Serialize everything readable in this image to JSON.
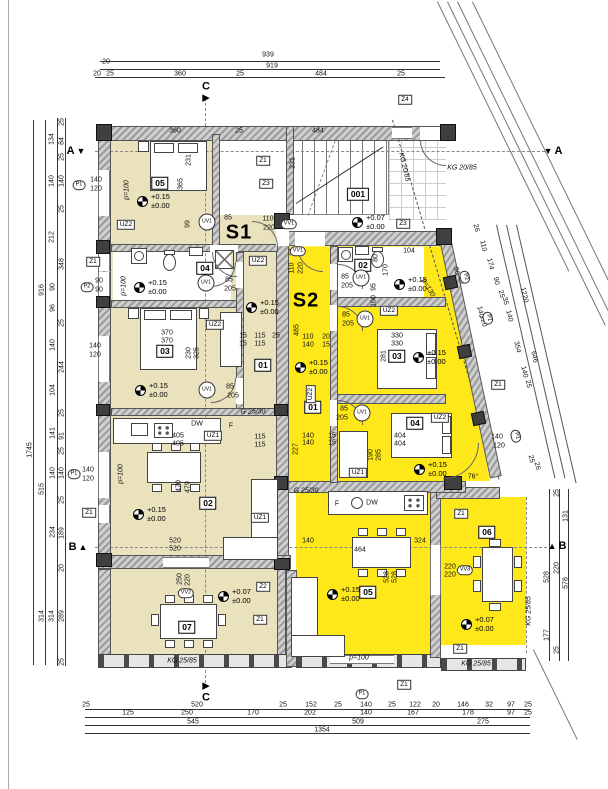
{
  "colors": {
    "s1_fill": "#e9e2bd",
    "s2_fill": "#ffe81a"
  },
  "units": [
    {
      "t": "S1",
      "x": 239,
      "y": 233
    },
    {
      "t": "S2",
      "x": 306,
      "y": 301
    }
  ],
  "sections": [
    {
      "t": "A",
      "tri": "▼",
      "x": 76,
      "y": 151,
      "side": "l"
    },
    {
      "t": "A",
      "tri": "▼",
      "x": 553,
      "y": 151,
      "side": "r"
    },
    {
      "t": "B",
      "tri": "▲",
      "x": 78,
      "y": 547,
      "side": "l"
    },
    {
      "t": "B",
      "tri": "▲",
      "x": 557,
      "y": 546,
      "side": "r"
    },
    {
      "t": "C",
      "tri": "▶",
      "x": 206,
      "y": 92,
      "side": "t"
    },
    {
      "t": "C",
      "tri": "▶",
      "x": 206,
      "y": 692,
      "side": "b"
    }
  ],
  "roomboxes": [
    {
      "t": "05",
      "x": 160,
      "y": 183
    },
    {
      "t": "001",
      "x": 358,
      "y": 194
    },
    {
      "t": "04",
      "x": 205,
      "y": 268
    },
    {
      "t": "02",
      "x": 363,
      "y": 265
    },
    {
      "t": "03",
      "x": 165,
      "y": 351
    },
    {
      "t": "01",
      "x": 263,
      "y": 365
    },
    {
      "t": "03",
      "x": 397,
      "y": 356
    },
    {
      "t": "01",
      "x": 313,
      "y": 407
    },
    {
      "t": "04",
      "x": 415,
      "y": 423
    },
    {
      "t": "02",
      "x": 208,
      "y": 503
    },
    {
      "t": "05",
      "x": 368,
      "y": 592
    },
    {
      "t": "07",
      "x": 187,
      "y": 627
    },
    {
      "t": "06",
      "x": 487,
      "y": 532
    }
  ],
  "zboxes": [
    {
      "t": "Z4",
      "x": 405,
      "y": 100
    },
    {
      "t": "Z1",
      "x": 263,
      "y": 161
    },
    {
      "t": "Z3",
      "x": 266,
      "y": 184
    },
    {
      "t": "Z3",
      "x": 403,
      "y": 224
    },
    {
      "t": "Z2",
      "x": 263,
      "y": 587
    },
    {
      "t": "Z1",
      "x": 260,
      "y": 620
    },
    {
      "t": "Z1",
      "x": 461,
      "y": 514
    },
    {
      "t": "Z1",
      "x": 460,
      "y": 649
    },
    {
      "t": "Z1",
      "x": 404,
      "y": 685
    },
    {
      "t": "Z1",
      "x": 498,
      "y": 385
    },
    {
      "t": "Z1",
      "x": 89,
      "y": 513
    },
    {
      "t": "Z1",
      "x": 93,
      "y": 262
    }
  ],
  "uzboxes": [
    {
      "t": "UZ2",
      "x": 126,
      "y": 225
    },
    {
      "t": "UZ2",
      "x": 215,
      "y": 325
    },
    {
      "t": "UZ2",
      "x": 258,
      "y": 261
    },
    {
      "t": "UZ1",
      "x": 213,
      "y": 436
    },
    {
      "t": "UZ1",
      "x": 260,
      "y": 518
    },
    {
      "t": "UZ2",
      "x": 389,
      "y": 311
    },
    {
      "t": "UZ2",
      "x": 440,
      "y": 418
    },
    {
      "t": "UZ1",
      "x": 358,
      "y": 473
    },
    {
      "t": "UZ2",
      "x": 311,
      "y": 394,
      "r": -90
    }
  ],
  "circles": [
    {
      "t": "UV1",
      "x": 207,
      "y": 222
    },
    {
      "t": "UV1",
      "x": 206,
      "y": 283
    },
    {
      "t": "UV1",
      "x": 207,
      "y": 390
    },
    {
      "t": "UV1",
      "x": 361,
      "y": 278
    },
    {
      "t": "UV1",
      "x": 365,
      "y": 319
    },
    {
      "t": "UV1",
      "x": 362,
      "y": 413
    }
  ],
  "hexes": [
    {
      "t": "VV1",
      "x": 289,
      "y": 224
    },
    {
      "t": "VV1",
      "x": 298,
      "y": 251
    },
    {
      "t": "VV2",
      "x": 186,
      "y": 593
    },
    {
      "t": "VV3",
      "x": 465,
      "y": 570
    },
    {
      "t": "P1",
      "x": 79,
      "y": 185
    },
    {
      "t": "P2",
      "x": 87,
      "y": 287
    },
    {
      "t": "P1",
      "x": 74,
      "y": 474
    },
    {
      "t": "P2",
      "x": 465,
      "y": 277,
      "r": 77
    },
    {
      "t": "P1",
      "x": 488,
      "y": 318,
      "r": 77
    },
    {
      "t": "P1",
      "x": 516,
      "y": 436,
      "r": 77
    },
    {
      "t": "P1",
      "x": 362,
      "y": 694
    }
  ],
  "elev": [
    {
      "a": "+0.15",
      "b": "±0.00",
      "x": 137,
      "y": 201
    },
    {
      "a": "+0.15",
      "b": "±0.00",
      "x": 134,
      "y": 287
    },
    {
      "a": "+0.15",
      "b": "±0.00",
      "x": 246,
      "y": 307
    },
    {
      "a": "+0.15",
      "b": "±0.00",
      "x": 135,
      "y": 390
    },
    {
      "a": "+0.15",
      "b": "±0.00",
      "x": 133,
      "y": 514
    },
    {
      "a": "+0.07",
      "b": "±0.00",
      "x": 218,
      "y": 596
    },
    {
      "a": "+0.07",
      "b": "±0.00",
      "x": 352,
      "y": 222
    },
    {
      "a": "+0.15",
      "b": "±0.00",
      "x": 394,
      "y": 284
    },
    {
      "a": "+0.15",
      "b": "±0.00",
      "x": 413,
      "y": 357
    },
    {
      "a": "+0.15",
      "b": "±0.00",
      "x": 295,
      "y": 367
    },
    {
      "a": "+0.15",
      "b": "±0.00",
      "x": 414,
      "y": 469
    },
    {
      "a": "+0.15",
      "b": "±0.00",
      "x": 327,
      "y": 594
    },
    {
      "a": "+0.07",
      "b": "±0.00",
      "x": 461,
      "y": 624
    }
  ],
  "texts": [
    {
      "t": "939",
      "x": 268,
      "y": 55
    },
    {
      "t": "919",
      "x": 272,
      "y": 66
    },
    {
      "t": "20",
      "x": 106,
      "y": 62
    },
    {
      "t": "20",
      "x": 97,
      "y": 74
    },
    {
      "t": "25",
      "x": 110,
      "y": 74
    },
    {
      "t": "360",
      "x": 180,
      "y": 74
    },
    {
      "t": "25",
      "x": 240,
      "y": 74
    },
    {
      "t": "484",
      "x": 321,
      "y": 74
    },
    {
      "t": "25",
      "x": 401,
      "y": 74
    },
    {
      "t": "360",
      "x": 175,
      "y": 131
    },
    {
      "t": "25",
      "x": 239,
      "y": 131
    },
    {
      "t": "484",
      "x": 318,
      "y": 131
    },
    {
      "t": "1745",
      "x": 30,
      "y": 450,
      "r": -90
    },
    {
      "t": "916",
      "x": 42,
      "y": 290,
      "r": -90
    },
    {
      "t": "515",
      "x": 42,
      "y": 489,
      "r": -90
    },
    {
      "t": "314",
      "x": 42,
      "y": 616,
      "r": -90
    },
    {
      "t": "314",
      "x": 52,
      "y": 616,
      "r": -90
    },
    {
      "t": "289",
      "x": 62,
      "y": 616,
      "r": -90
    },
    {
      "t": "25",
      "x": 62,
      "y": 122,
      "r": -90
    },
    {
      "t": "134",
      "x": 52,
      "y": 139,
      "r": -90
    },
    {
      "t": "84",
      "x": 62,
      "y": 141,
      "r": -90
    },
    {
      "t": "25",
      "x": 62,
      "y": 157,
      "r": -90
    },
    {
      "t": "140",
      "x": 52,
      "y": 181,
      "r": -90
    },
    {
      "t": "140",
      "x": 62,
      "y": 181,
      "r": -90
    },
    {
      "t": "25",
      "x": 62,
      "y": 209,
      "r": -90
    },
    {
      "t": "212",
      "x": 52,
      "y": 237,
      "r": -90
    },
    {
      "t": "348",
      "x": 62,
      "y": 264,
      "r": -90
    },
    {
      "t": "90",
      "x": 53,
      "y": 287,
      "r": -90
    },
    {
      "t": "96",
      "x": 53,
      "y": 308,
      "r": -90
    },
    {
      "t": "25",
      "x": 62,
      "y": 323,
      "r": -90
    },
    {
      "t": "140",
      "x": 53,
      "y": 345,
      "r": -90
    },
    {
      "t": "244",
      "x": 62,
      "y": 367,
      "r": -90
    },
    {
      "t": "104",
      "x": 53,
      "y": 390,
      "r": -90
    },
    {
      "t": "25",
      "x": 62,
      "y": 413,
      "r": -90
    },
    {
      "t": "141",
      "x": 53,
      "y": 433,
      "r": -90
    },
    {
      "t": "91",
      "x": 62,
      "y": 436,
      "r": -90
    },
    {
      "t": "25",
      "x": 62,
      "y": 451,
      "r": -90
    },
    {
      "t": "140",
      "x": 53,
      "y": 473,
      "r": -90
    },
    {
      "t": "140",
      "x": 62,
      "y": 473,
      "r": -90
    },
    {
      "t": "25",
      "x": 62,
      "y": 500,
      "r": -90
    },
    {
      "t": "234",
      "x": 53,
      "y": 532,
      "r": -90
    },
    {
      "t": "189",
      "x": 62,
      "y": 533,
      "r": -90
    },
    {
      "t": "20",
      "x": 62,
      "y": 568,
      "r": -90
    },
    {
      "t": "25",
      "x": 62,
      "y": 662,
      "r": -90
    },
    {
      "t": "140",
      "x": 96,
      "y": 180
    },
    {
      "t": "120",
      "x": 96,
      "y": 189
    },
    {
      "t": "90",
      "x": 99,
      "y": 281
    },
    {
      "t": "90",
      "x": 99,
      "y": 290
    },
    {
      "t": "140",
      "x": 95,
      "y": 346
    },
    {
      "t": "120",
      "x": 95,
      "y": 355
    },
    {
      "t": "140",
      "x": 88,
      "y": 470
    },
    {
      "t": "120",
      "x": 88,
      "y": 479
    },
    {
      "t": "25",
      "x": 86,
      "y": 705
    },
    {
      "t": "520",
      "x": 197,
      "y": 705
    },
    {
      "t": "25",
      "x": 283,
      "y": 705
    },
    {
      "t": "152",
      "x": 311,
      "y": 705
    },
    {
      "t": "25",
      "x": 338,
      "y": 705
    },
    {
      "t": "140",
      "x": 366,
      "y": 705
    },
    {
      "t": "25",
      "x": 392,
      "y": 705
    },
    {
      "t": "122",
      "x": 415,
      "y": 705
    },
    {
      "t": "20",
      "x": 436,
      "y": 705
    },
    {
      "t": "146",
      "x": 463,
      "y": 705
    },
    {
      "t": "32",
      "x": 489,
      "y": 705
    },
    {
      "t": "97",
      "x": 511,
      "y": 705
    },
    {
      "t": "25",
      "x": 528,
      "y": 705
    },
    {
      "t": "125",
      "x": 128,
      "y": 713
    },
    {
      "t": "250",
      "x": 187,
      "y": 713
    },
    {
      "t": "170",
      "x": 253,
      "y": 713
    },
    {
      "t": "202",
      "x": 310,
      "y": 713
    },
    {
      "t": "140",
      "x": 366,
      "y": 713
    },
    {
      "t": "167",
      "x": 413,
      "y": 713
    },
    {
      "t": "178",
      "x": 468,
      "y": 713
    },
    {
      "t": "97",
      "x": 511,
      "y": 713
    },
    {
      "t": "25",
      "x": 528,
      "y": 713
    },
    {
      "t": "545",
      "x": 193,
      "y": 722
    },
    {
      "t": "509",
      "x": 358,
      "y": 722
    },
    {
      "t": "275",
      "x": 483,
      "y": 722
    },
    {
      "t": "1354",
      "x": 322,
      "y": 730
    },
    {
      "t": "25",
      "x": 557,
      "y": 493,
      "r": -90
    },
    {
      "t": "131",
      "x": 566,
      "y": 516,
      "r": -90
    },
    {
      "t": "220",
      "x": 557,
      "y": 568,
      "r": -90
    },
    {
      "t": "528",
      "x": 547,
      "y": 577,
      "r": -90
    },
    {
      "t": "578",
      "x": 566,
      "y": 583,
      "r": -90
    },
    {
      "t": "177",
      "x": 547,
      "y": 635,
      "r": -90
    },
    {
      "t": "25",
      "x": 557,
      "y": 650,
      "r": -90
    },
    {
      "t": "26",
      "x": 476,
      "y": 228,
      "r": 77
    },
    {
      "t": "110",
      "x": 483,
      "y": 246,
      "r": 77
    },
    {
      "t": "174",
      "x": 490,
      "y": 264,
      "r": 77
    },
    {
      "t": "90",
      "x": 496,
      "y": 281,
      "r": 77
    },
    {
      "t": "25",
      "x": 501,
      "y": 294,
      "r": 77
    },
    {
      "t": "35",
      "x": 505,
      "y": 301,
      "r": 77
    },
    {
      "t": "140",
      "x": 509,
      "y": 316,
      "r": 77
    },
    {
      "t": "354",
      "x": 517,
      "y": 347,
      "r": 77
    },
    {
      "t": "140",
      "x": 524,
      "y": 372,
      "r": 77
    },
    {
      "t": "25",
      "x": 528,
      "y": 384,
      "r": 77
    },
    {
      "t": "1220",
      "x": 524,
      "y": 295,
      "r": 77
    },
    {
      "t": "646",
      "x": 534,
      "y": 357,
      "r": 77
    },
    {
      "t": "25",
      "x": 531,
      "y": 459,
      "r": 77
    },
    {
      "t": "26",
      "x": 537,
      "y": 466,
      "r": 77
    },
    {
      "t": "90",
      "x": 456,
      "y": 271,
      "r": 77
    },
    {
      "t": "90",
      "x": 461,
      "y": 280,
      "r": 77
    },
    {
      "t": "140",
      "x": 480,
      "y": 312,
      "r": 77
    },
    {
      "t": "120",
      "x": 483,
      "y": 321,
      "r": 77
    },
    {
      "t": "140",
      "x": 497,
      "y": 437
    },
    {
      "t": "120",
      "x": 499,
      "y": 446
    },
    {
      "t": "231",
      "x": 189,
      "y": 160,
      "r": -90
    },
    {
      "t": "365",
      "x": 181,
      "y": 184,
      "r": -90
    },
    {
      "t": "231",
      "x": 293,
      "y": 163,
      "r": -90
    },
    {
      "t": "99",
      "x": 188,
      "y": 224,
      "r": -90
    },
    {
      "t": "85",
      "x": 228,
      "y": 218
    },
    {
      "t": "110",
      "x": 268,
      "y": 219
    },
    {
      "t": "220",
      "x": 269,
      "y": 228
    },
    {
      "t": "85",
      "x": 229,
      "y": 280
    },
    {
      "t": "205",
      "x": 230,
      "y": 289
    },
    {
      "t": "85",
      "x": 230,
      "y": 387
    },
    {
      "t": "205",
      "x": 233,
      "y": 396
    },
    {
      "t": "15",
      "x": 243,
      "y": 336
    },
    {
      "t": "15",
      "x": 243,
      "y": 344
    },
    {
      "t": "115",
      "x": 260,
      "y": 336
    },
    {
      "t": "115",
      "x": 260,
      "y": 344
    },
    {
      "t": "25",
      "x": 276,
      "y": 336
    },
    {
      "t": "370",
      "x": 167,
      "y": 333
    },
    {
      "t": "370",
      "x": 167,
      "y": 341
    },
    {
      "t": "325",
      "x": 197,
      "y": 353,
      "r": -90
    },
    {
      "t": "230",
      "x": 189,
      "y": 353,
      "r": -90
    },
    {
      "t": "405",
      "x": 178,
      "y": 436
    },
    {
      "t": "405",
      "x": 178,
      "y": 444
    },
    {
      "t": "115",
      "x": 260,
      "y": 437
    },
    {
      "t": "115",
      "x": 260,
      "y": 445
    },
    {
      "t": "520",
      "x": 175,
      "y": 541
    },
    {
      "t": "520",
      "x": 175,
      "y": 549
    },
    {
      "t": "470",
      "x": 179,
      "y": 486,
      "r": -90
    },
    {
      "t": "479",
      "x": 188,
      "y": 487,
      "r": -90
    },
    {
      "t": "250",
      "x": 180,
      "y": 579,
      "r": -90
    },
    {
      "t": "220",
      "x": 188,
      "y": 580,
      "r": -90
    },
    {
      "t": "DW",
      "x": 197,
      "y": 424
    },
    {
      "t": "F",
      "x": 231,
      "y": 426
    },
    {
      "t": "104",
      "x": 409,
      "y": 251
    },
    {
      "t": "80",
      "x": 376,
      "y": 258,
      "r": -90
    },
    {
      "t": "170",
      "x": 386,
      "y": 270,
      "r": -90
    },
    {
      "t": "95",
      "x": 374,
      "y": 287,
      "r": -90
    },
    {
      "t": "100",
      "x": 374,
      "y": 301,
      "r": -90
    },
    {
      "t": "85",
      "x": 345,
      "y": 277
    },
    {
      "t": "205",
      "x": 347,
      "y": 286
    },
    {
      "t": "85",
      "x": 346,
      "y": 315
    },
    {
      "t": "205",
      "x": 348,
      "y": 324
    },
    {
      "t": "85",
      "x": 344,
      "y": 409
    },
    {
      "t": "205",
      "x": 342,
      "y": 418
    },
    {
      "t": "110",
      "x": 292,
      "y": 268,
      "r": -90
    },
    {
      "t": "220",
      "x": 301,
      "y": 268,
      "r": -90
    },
    {
      "t": "25",
      "x": 293,
      "y": 252,
      "r": -90
    },
    {
      "t": "35",
      "x": 300,
      "y": 252,
      "r": -90
    },
    {
      "t": "485",
      "x": 297,
      "y": 330,
      "r": -90
    },
    {
      "t": "227",
      "x": 296,
      "y": 449,
      "r": -90
    },
    {
      "t": "110",
      "x": 308,
      "y": 337
    },
    {
      "t": "140",
      "x": 308,
      "y": 345
    },
    {
      "t": "20",
      "x": 326,
      "y": 337
    },
    {
      "t": "15",
      "x": 326,
      "y": 345
    },
    {
      "t": "330",
      "x": 397,
      "y": 336
    },
    {
      "t": "330",
      "x": 397,
      "y": 344
    },
    {
      "t": "281",
      "x": 384,
      "y": 356,
      "r": -90
    },
    {
      "t": "404",
      "x": 400,
      "y": 436
    },
    {
      "t": "404",
      "x": 400,
      "y": 444
    },
    {
      "t": "140",
      "x": 308,
      "y": 436
    },
    {
      "t": "140",
      "x": 308,
      "y": 443
    },
    {
      "t": "15",
      "x": 332,
      "y": 436
    },
    {
      "t": "15",
      "x": 332,
      "y": 443
    },
    {
      "t": "190",
      "x": 371,
      "y": 455,
      "r": -90
    },
    {
      "t": "285",
      "x": 379,
      "y": 455,
      "r": -90
    },
    {
      "t": "140",
      "x": 308,
      "y": 541
    },
    {
      "t": "464",
      "x": 360,
      "y": 550
    },
    {
      "t": "324",
      "x": 420,
      "y": 541
    },
    {
      "t": "528",
      "x": 387,
      "y": 577,
      "r": -90
    },
    {
      "t": "528",
      "x": 395,
      "y": 577,
      "r": -90
    },
    {
      "t": "220",
      "x": 450,
      "y": 567
    },
    {
      "t": "220",
      "x": 450,
      "y": 575
    },
    {
      "t": "76°",
      "x": 473,
      "y": 477
    },
    {
      "t": "DW",
      "x": 372,
      "y": 503
    },
    {
      "t": "F",
      "x": 337,
      "y": 504
    },
    {
      "t": "KG 20/85",
      "x": 462,
      "y": 168,
      "i": 1
    },
    {
      "t": "KG 20/85",
      "x": 404,
      "y": 167,
      "r": 77,
      "i": 1
    },
    {
      "t": "KG 25/85",
      "x": 182,
      "y": 661,
      "i": 1
    },
    {
      "t": "KG 25/85",
      "x": 476,
      "y": 664,
      "i": 1
    },
    {
      "t": "KG 25/85",
      "x": 529,
      "y": 611,
      "r": -90,
      "i": 1
    },
    {
      "t": "G 25/30",
      "x": 253,
      "y": 412,
      "i": 1
    },
    {
      "t": "G 25/30",
      "x": 306,
      "y": 491,
      "i": 1
    },
    {
      "t": "p=100",
      "x": 127,
      "y": 190,
      "r": -90,
      "i": 1
    },
    {
      "t": "p=100",
      "x": 124,
      "y": 286,
      "r": -90,
      "i": 1
    },
    {
      "t": "p=100",
      "x": 121,
      "y": 474,
      "r": -90,
      "i": 1
    },
    {
      "t": "p=100",
      "x": 359,
      "y": 658,
      "i": 1
    },
    {
      "t": "p=130",
      "x": 428,
      "y": 288,
      "r": 60,
      "i": 1
    }
  ]
}
